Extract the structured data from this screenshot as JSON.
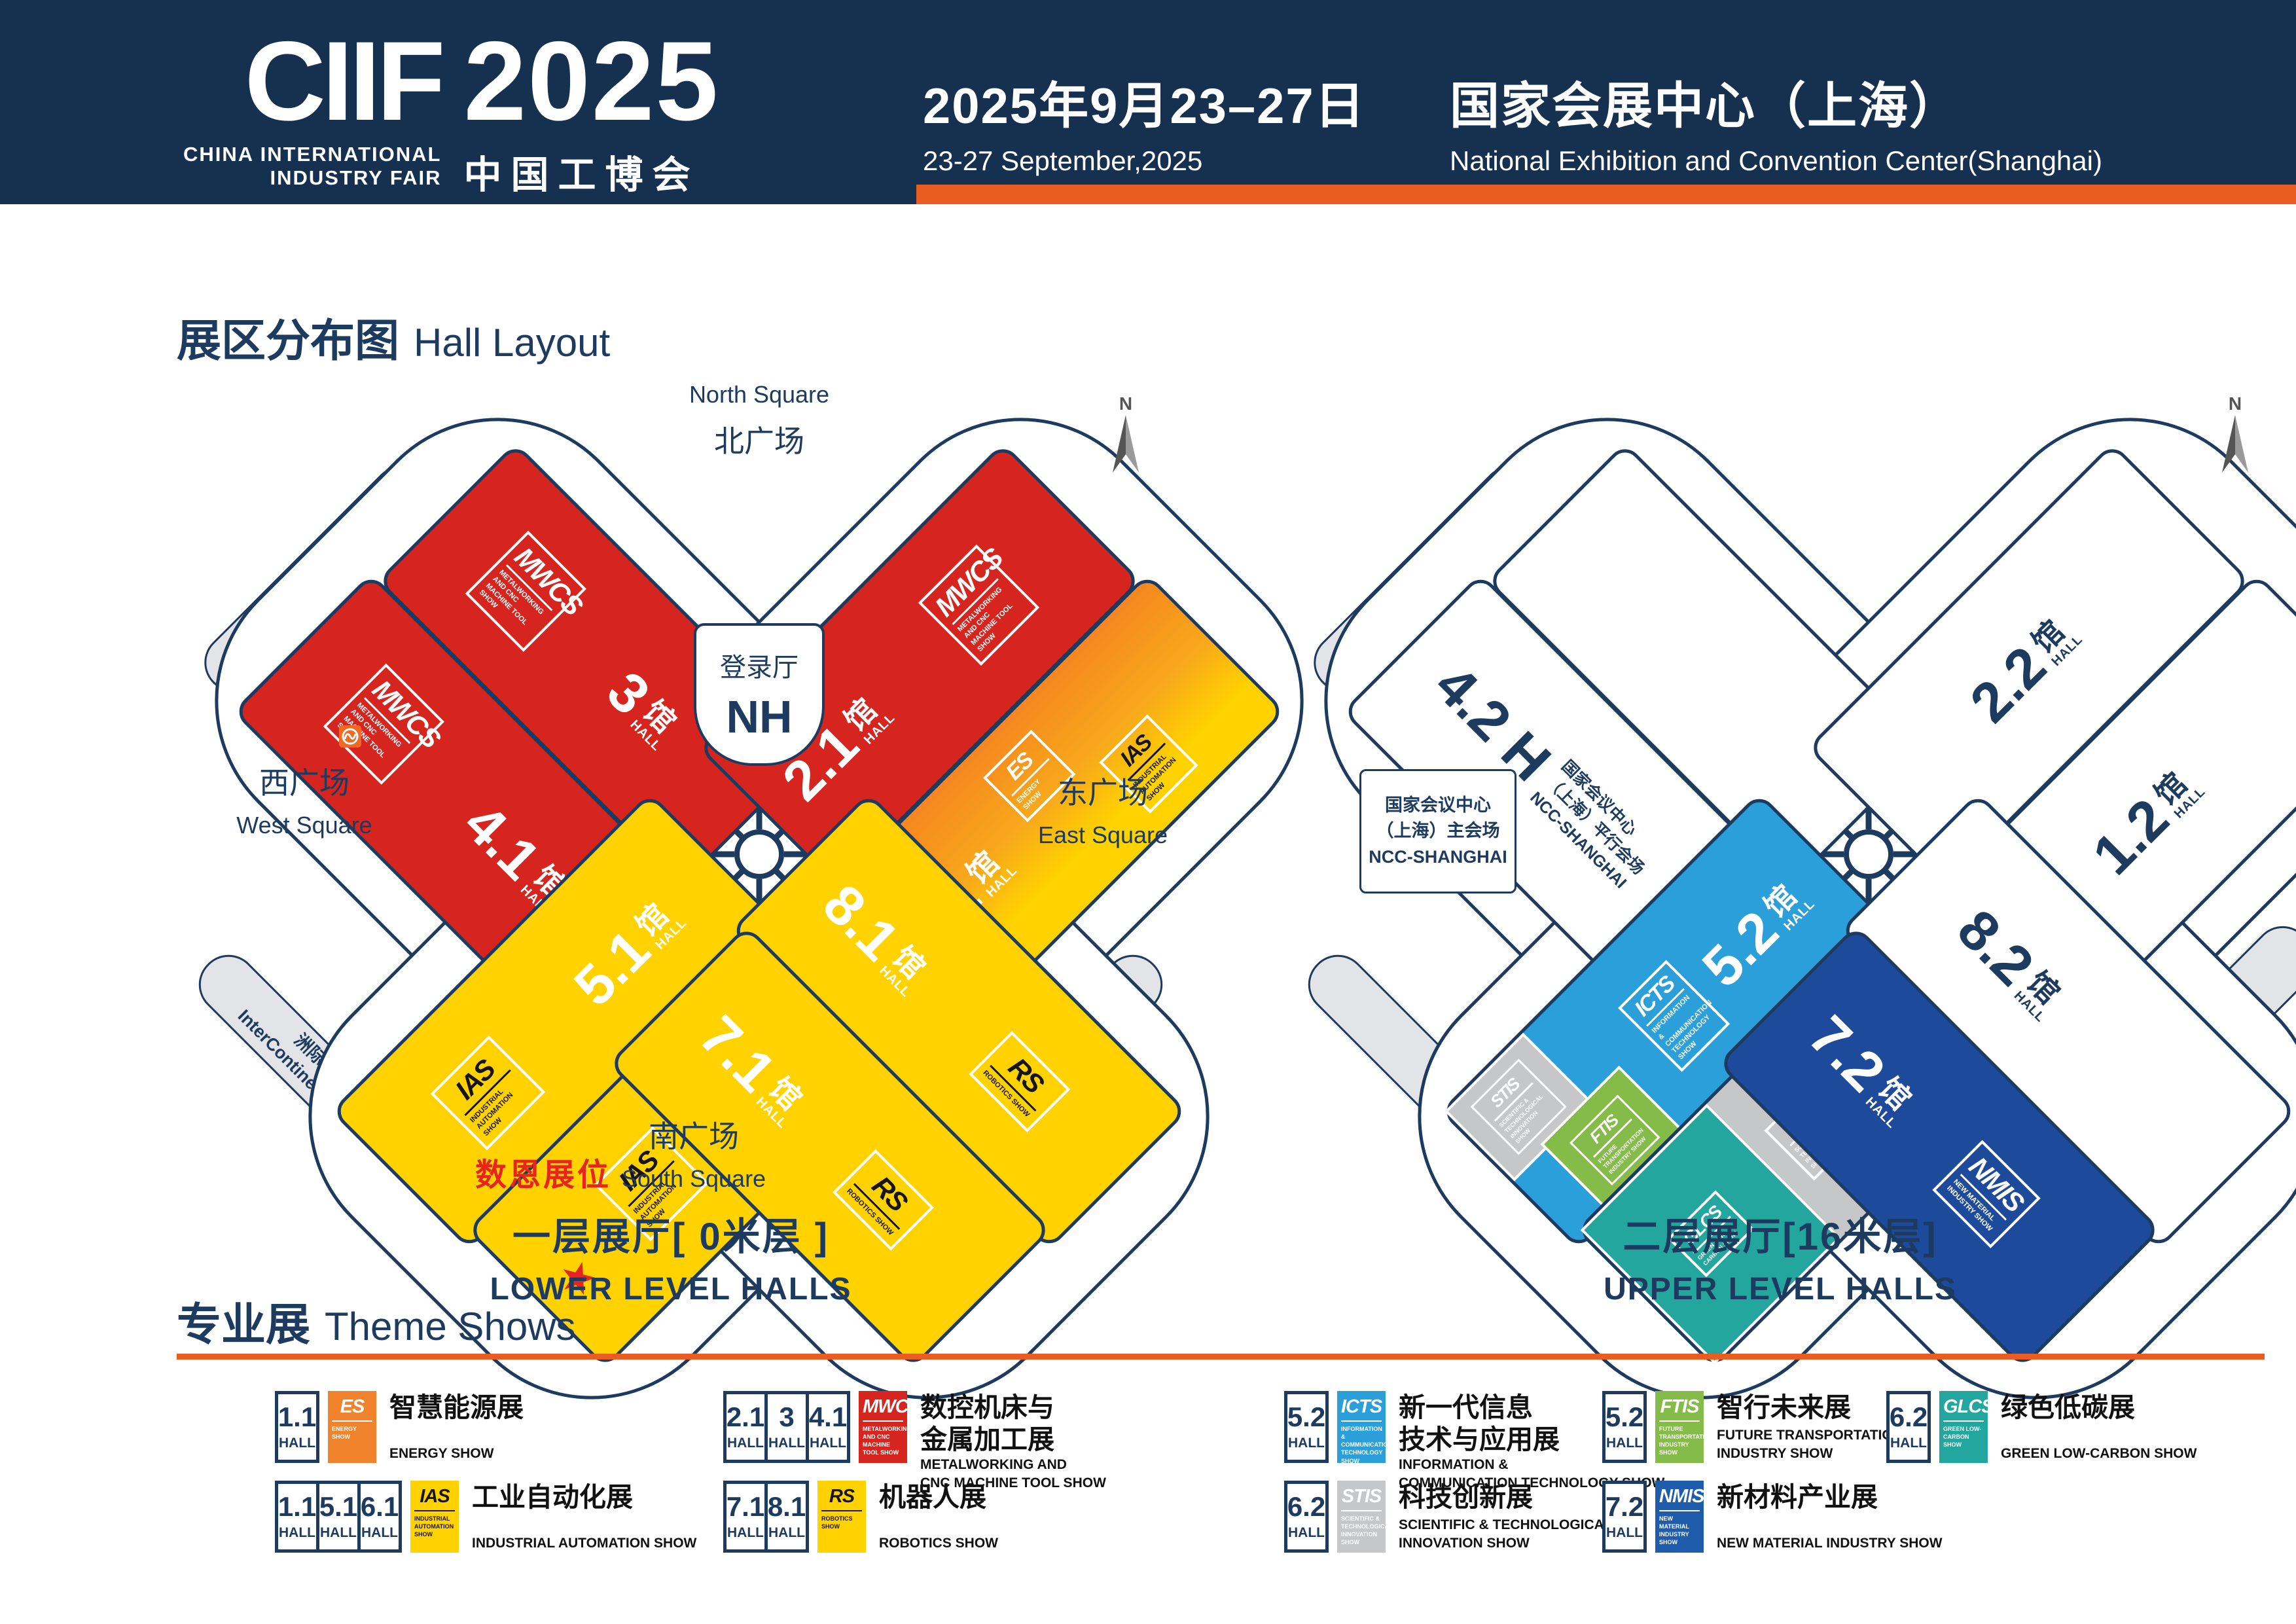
{
  "header": {
    "ciif": "CIIF",
    "year": "2025",
    "tagline1": "CHINA INTERNATIONAL",
    "tagline2": "INDUSTRY FAIR",
    "cn_name": "中国工博会",
    "date_cn": "2025年9月23–27日",
    "date_en": "23-27 September,2025",
    "venue_cn": "国家会展中心（上海）",
    "venue_en": "National Exhibition and Convention Center(Shanghai)"
  },
  "section": {
    "hall_layout_cn": "展区分布图",
    "hall_layout_en": "Hall Layout"
  },
  "common": {
    "guan": "馆",
    "hall": "HALL"
  },
  "logos": {
    "MWCS": {
      "name": "MWCS",
      "sub": "METALWORKING AND CNC MACHINE TOOL SHOW"
    },
    "ES": {
      "name": "ES",
      "sub": "ENERGY SHOW"
    },
    "IAS": {
      "name": "IAS",
      "sub": "INDUSTRIAL AUTOMATION SHOW"
    },
    "RS": {
      "name": "RS",
      "sub": "ROBOTICS SHOW"
    },
    "ICTS": {
      "name": "ICTS",
      "sub": "INFORMATION & COMMUNICATION TECHNOLOGY SHOW"
    },
    "FTIS": {
      "name": "FTIS",
      "sub": "FUTURE TRANSPORTATION INDUSTRY SHOW"
    },
    "STIS": {
      "name": "STIS",
      "sub": "SCIENTIFIC & TECHNOLOGICAL INNOVATION SHOW"
    },
    "GLCS": {
      "name": "GLCS",
      "sub": "GREEN LOW-CARBON SHOW"
    },
    "NMIS": {
      "name": "NMIS",
      "sub": "NEW MATERIAL INDUSTRY SHOW"
    }
  },
  "left_map": {
    "labels": {
      "north_en": "North Square",
      "north_cn": "北广场",
      "login_cn": "登录厅",
      "login_en": "NH",
      "west_cn": "西广场",
      "west_en": "West Square",
      "east_cn": "东广场",
      "east_en": "East Square",
      "south_cn": "南广场",
      "south_en": "South Square",
      "office_a_cn": "办公楼A",
      "office_a_en": "Office Building A",
      "office_b_cn": "办公楼B",
      "office_b_en": "Office Building B",
      "office_c_cn": "办公楼C",
      "office_c_en": "Office Building C",
      "hotel_cn": "洲际酒店",
      "hotel_en": "InterContinental Hotel",
      "booth": "数恩展位",
      "compass": "N"
    },
    "halls": {
      "h3": "3",
      "h41": "4.1",
      "h21": "2.1",
      "h11": "1.1",
      "h51": "5.1",
      "h61": "6.1",
      "h71": "7.1",
      "h81": "8.1"
    },
    "caption_cn": "一层展厅[ 0米层 ]",
    "caption_en": "LOWER LEVEL HALLS"
  },
  "right_map": {
    "labels": {
      "ncc_parallel_l1": "国家会议中心",
      "ncc_parallel_l2": "（上海）平行会场",
      "ncc_parallel_l3": "NCC-SHANGHAI",
      "ncc_main_l1": "国家会议中心",
      "ncc_main_l2": "（上海）主会场",
      "ncc_main_l3": "NCC-SHANGHAI",
      "c0_cn": "C0会议室（3楼）",
      "c0_en": "C0 Meeting Room",
      "compass": "N"
    },
    "halls": {
      "h42": "4.2 H",
      "h22": "2.2",
      "h12": "1.2",
      "h52": "5.2",
      "h62": "6.2",
      "h72": "7.2",
      "h82": "8.2"
    },
    "caption_cn": "二层展厅[16米层]",
    "caption_en": "UPPER LEVEL HALLS"
  },
  "theme_shows": {
    "title_cn": "专业展",
    "title_en": "Theme Shows",
    "hall_label": "HALL",
    "entries": [
      {
        "halls": [
          "1.1"
        ],
        "logo": "ES",
        "cn": "智慧能源展",
        "en": "ENERGY SHOW"
      },
      {
        "halls": [
          "2.1",
          "3",
          "4.1"
        ],
        "logo": "MWCS",
        "cn": "数控机床与\n金属加工展",
        "en": "METALWORKING AND\nCNC MACHINE TOOL SHOW"
      },
      {
        "halls": [
          "5.2"
        ],
        "logo": "ICTS",
        "cn": "新一代信息\n技术与应用展",
        "en": "INFORMATION &\nCOMMUNICATION TECHNOLOGY SHOW"
      },
      {
        "halls": [
          "5.2"
        ],
        "logo": "FTIS",
        "cn": "智行未来展",
        "en": "FUTURE TRANSPORTATION\nINDUSTRY SHOW"
      },
      {
        "halls": [
          "6.2"
        ],
        "logo": "GLCS",
        "cn": "绿色低碳展",
        "en": "GREEN LOW-CARBON SHOW"
      },
      {
        "halls": [
          "1.1",
          "5.1",
          "6.1"
        ],
        "logo": "IAS",
        "cn": "工业自动化展",
        "en": "INDUSTRIAL AUTOMATION SHOW"
      },
      {
        "halls": [
          "7.1",
          "8.1"
        ],
        "logo": "RS",
        "cn": "机器人展",
        "en": "ROBOTICS SHOW"
      },
      {
        "halls": [
          "6.2"
        ],
        "logo": "STIS",
        "cn": "科技创新展",
        "en": "SCIENTIFIC & TECHNOLOGICAL\nINNOVATION SHOW"
      },
      {
        "halls": [
          "7.2"
        ],
        "logo": "NMIS",
        "cn": "新材料产业展",
        "en": "NEW MATERIAL INDUSTRY SHOW"
      }
    ]
  },
  "colors": {
    "accent": "#e95d20",
    "ink": "#1d3a5f",
    "red": "#d6251f",
    "yellow": "#ffd200",
    "blue": "#2b9fd9",
    "green": "#85bb49",
    "teal": "#23a69d",
    "gray": "#c6c7c9",
    "dark_blue": "#1e4a9b"
  }
}
